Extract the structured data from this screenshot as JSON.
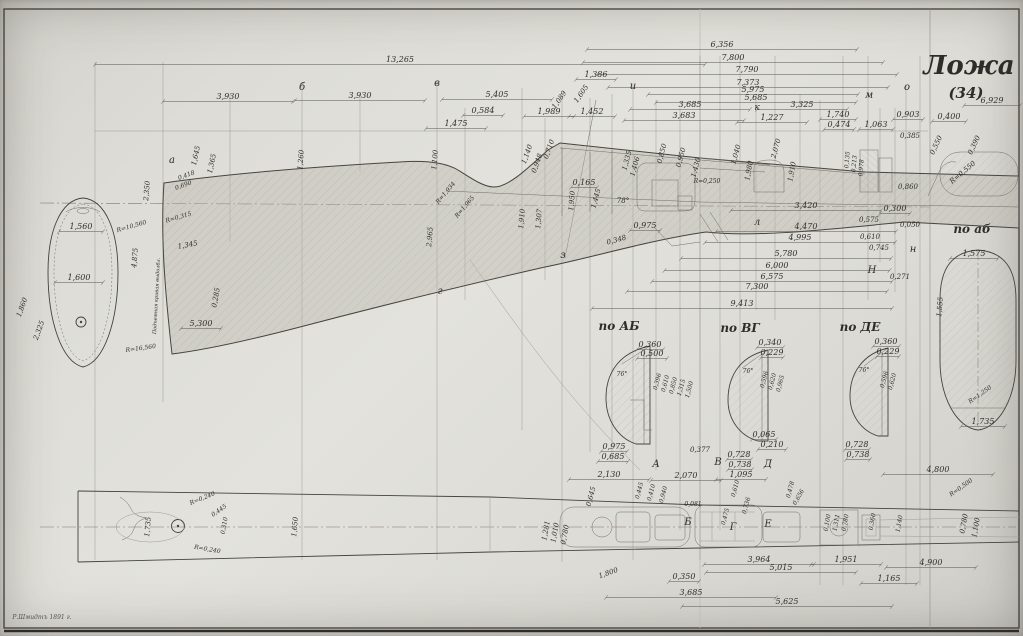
{
  "title": {
    "main": "Ложа",
    "sub": "(34)"
  },
  "section_labels": {
    "ab_upper": "по АБ",
    "vg": "по ВГ",
    "de": "по ДЕ",
    "ab_lower": "по аб"
  },
  "signature": "Р.Шмидтъ 1891 г.",
  "annotations": [
    {
      "t": "13,265",
      "x": 400,
      "y": 62,
      "w": 610
    },
    {
      "t": "3,930",
      "x": 228,
      "y": 99,
      "w": 130
    },
    {
      "t": "3,930",
      "x": 360,
      "y": 98,
      "w": 130
    },
    {
      "t": "5,405",
      "x": 497,
      "y": 97,
      "w": 110
    },
    {
      "t": "6,356",
      "x": 722,
      "y": 47,
      "w": 270
    },
    {
      "t": "7,800",
      "x": 733,
      "y": 60,
      "w": 300
    },
    {
      "t": "7,790",
      "x": 747,
      "y": 72,
      "w": 300
    },
    {
      "t": "7,373",
      "x": 748,
      "y": 85,
      "w": 280
    },
    {
      "t": "5,975",
      "x": 753,
      "y": 92,
      "w": 210
    },
    {
      "t": "5,685",
      "x": 756,
      "y": 100,
      "w": 200
    },
    {
      "t": "3,685",
      "x": 690,
      "y": 107,
      "w": 120
    },
    {
      "t": "3,683",
      "x": 684,
      "y": 118,
      "w": 120
    },
    {
      "t": "3,325",
      "x": 802,
      "y": 107,
      "w": 90
    },
    {
      "t": "1,227",
      "x": 772,
      "y": 120,
      "w": 70
    },
    {
      "t": "0,584",
      "x": 483,
      "y": 113,
      "w": 40
    },
    {
      "t": "1,475",
      "x": 456,
      "y": 126,
      "w": 60
    },
    {
      "t": "1,989",
      "x": 549,
      "y": 114,
      "w": 50
    },
    {
      "t": "1,452",
      "x": 592,
      "y": 114,
      "w": 46
    },
    {
      "t": "1,386",
      "x": 596,
      "y": 77,
      "w": 40
    },
    {
      "t": "1,740",
      "x": 838,
      "y": 117,
      "w": 36
    },
    {
      "t": "0,474",
      "x": 839,
      "y": 127,
      "w": 30
    },
    {
      "t": "1,063",
      "x": 876,
      "y": 127,
      "w": 34
    },
    {
      "t": "0,903",
      "x": 908,
      "y": 117,
      "w": 30
    },
    {
      "t": "0,400",
      "x": 949,
      "y": 119,
      "w": 34
    },
    {
      "t": "6,929",
      "x": 992,
      "y": 103,
      "w": 56
    },
    {
      "t": "0,385",
      "x": 910,
      "y": 138,
      "s": 7
    },
    {
      "t": "0,550",
      "x": 938,
      "y": 146,
      "r": -65,
      "s": 7
    },
    {
      "t": "0,390",
      "x": 976,
      "y": 146,
      "r": -65,
      "s": 7
    },
    {
      "t": "R=0,550",
      "x": 964,
      "y": 174,
      "r": -40,
      "s": 7
    },
    {
      "t": "0,860",
      "x": 908,
      "y": 189,
      "s": 7
    },
    {
      "t": "0,300",
      "x": 895,
      "y": 211,
      "w": 30
    },
    {
      "t": "3,420",
      "x": 806,
      "y": 208,
      "w": 150
    },
    {
      "t": "0,575",
      "x": 869,
      "y": 222,
      "s": 7
    },
    {
      "t": "0,050",
      "x": 910,
      "y": 227,
      "s": 7
    },
    {
      "t": "4,470",
      "x": 806,
      "y": 229,
      "w": 180
    },
    {
      "t": "4,995",
      "x": 800,
      "y": 240,
      "w": 190
    },
    {
      "t": "0,610",
      "x": 870,
      "y": 239,
      "s": 7
    },
    {
      "t": "0,745",
      "x": 879,
      "y": 250,
      "s": 7
    },
    {
      "t": "5,780",
      "x": 786,
      "y": 256,
      "w": 210
    },
    {
      "t": "6,000",
      "x": 777,
      "y": 268,
      "w": 225
    },
    {
      "t": "6,575",
      "x": 772,
      "y": 279,
      "w": 240
    },
    {
      "t": "7,300",
      "x": 757,
      "y": 289,
      "w": 260
    },
    {
      "t": "9,413",
      "x": 742,
      "y": 306,
      "w": 300
    },
    {
      "t": "0,271",
      "x": 900,
      "y": 279,
      "s": 7
    },
    {
      "t": "0,975",
      "x": 645,
      "y": 228,
      "w": 30
    },
    {
      "t": "0,348",
      "x": 617,
      "y": 242,
      "r": -15,
      "s": 7
    },
    {
      "t": "0,710",
      "x": 551,
      "y": 150,
      "r": -70,
      "s": 7
    },
    {
      "t": "1,140",
      "x": 529,
      "y": 155,
      "r": -70,
      "s": 7
    },
    {
      "t": "0,948",
      "x": 539,
      "y": 164,
      "r": -70,
      "s": 7
    },
    {
      "t": "1,605",
      "x": 583,
      "y": 95,
      "r": -55,
      "s": 7
    },
    {
      "t": "1,089",
      "x": 561,
      "y": 101,
      "r": -55,
      "s": 7
    },
    {
      "t": "0,850",
      "x": 664,
      "y": 154,
      "r": -75,
      "s": 7
    },
    {
      "t": "0,950",
      "x": 683,
      "y": 158,
      "r": -75,
      "s": 7
    },
    {
      "t": "1,430",
      "x": 698,
      "y": 168,
      "r": -75,
      "s": 7
    },
    {
      "t": "R=0,250",
      "x": 707,
      "y": 183,
      "s": 6
    },
    {
      "t": "1,040",
      "x": 738,
      "y": 155,
      "r": -75,
      "s": 7
    },
    {
      "t": "1,980",
      "x": 751,
      "y": 171,
      "r": -80,
      "s": 7
    },
    {
      "t": "2,070",
      "x": 778,
      "y": 149,
      "r": -75,
      "s": 7
    },
    {
      "t": "1,910",
      "x": 794,
      "y": 172,
      "r": -80,
      "s": 7
    },
    {
      "t": "1,335",
      "x": 629,
      "y": 161,
      "r": -75,
      "s": 7
    },
    {
      "t": "1,406",
      "x": 637,
      "y": 167,
      "r": -75,
      "s": 7
    },
    {
      "t": "78°",
      "x": 623,
      "y": 203,
      "s": 7
    },
    {
      "t": "0,165",
      "x": 584,
      "y": 185,
      "w": 26
    },
    {
      "t": "1,950",
      "x": 574,
      "y": 201,
      "r": -85,
      "s": 7
    },
    {
      "t": "1,445",
      "x": 598,
      "y": 199,
      "r": -75,
      "s": 7
    },
    {
      "t": "1,910",
      "x": 524,
      "y": 219,
      "r": -85,
      "s": 7
    },
    {
      "t": "1,307",
      "x": 541,
      "y": 219,
      "r": -85,
      "s": 7
    },
    {
      "t": "R=1,934",
      "x": 447,
      "y": 194,
      "r": -50,
      "s": 6
    },
    {
      "t": "R=1,965",
      "x": 466,
      "y": 208,
      "r": -50,
      "s": 6
    },
    {
      "t": "2,965",
      "x": 432,
      "y": 237,
      "r": -85,
      "s": 7
    },
    {
      "t": "1,100",
      "x": 437,
      "y": 160,
      "r": -85,
      "s": 7
    },
    {
      "t": "1,260",
      "x": 303,
      "y": 160,
      "r": -85,
      "s": 7
    },
    {
      "t": "2,350",
      "x": 149,
      "y": 191,
      "r": -85,
      "s": 7
    },
    {
      "t": "1,645",
      "x": 198,
      "y": 156,
      "r": -78,
      "s": 7
    },
    {
      "t": "1,365",
      "x": 214,
      "y": 164,
      "r": -78,
      "s": 7
    },
    {
      "t": "0,418",
      "x": 187,
      "y": 177,
      "r": -20,
      "s": 6
    },
    {
      "t": "0,690",
      "x": 184,
      "y": 187,
      "r": -20,
      "s": 6
    },
    {
      "t": "1,560",
      "x": 81,
      "y": 229,
      "w": 44
    },
    {
      "t": "1,600",
      "x": 79,
      "y": 280,
      "w": 48
    },
    {
      "t": "R=10,560",
      "x": 132,
      "y": 228,
      "r": -16,
      "s": 6
    },
    {
      "t": "R=0,315",
      "x": 179,
      "y": 219,
      "r": -16,
      "s": 6
    },
    {
      "t": "1,345",
      "x": 188,
      "y": 247,
      "r": -10,
      "s": 7
    },
    {
      "t": "4,875",
      "x": 137,
      "y": 258,
      "r": -85,
      "s": 7
    },
    {
      "t": "5,300",
      "x": 201,
      "y": 326,
      "w": 40
    },
    {
      "t": "R=16,560",
      "x": 141,
      "y": 350,
      "r": -8,
      "s": 6
    },
    {
      "t": "0,285",
      "x": 218,
      "y": 298,
      "r": -80,
      "s": 7
    },
    {
      "t": "2,325",
      "x": 41,
      "y": 331,
      "r": -70,
      "s": 7
    },
    {
      "t": "1,860",
      "x": 24,
      "y": 308,
      "r": -70,
      "s": 7
    },
    {
      "t": "Подъемная кривая выдолбл.",
      "x": 158,
      "y": 296,
      "r": -87,
      "s": 5
    },
    {
      "t": "а",
      "x": 172,
      "y": 163,
      "s": 10
    },
    {
      "t": "б",
      "x": 302,
      "y": 90,
      "s": 10
    },
    {
      "t": "в",
      "x": 437,
      "y": 86,
      "s": 10
    },
    {
      "t": "г",
      "x": 440,
      "y": 294,
      "s": 10
    },
    {
      "t": "з",
      "x": 563,
      "y": 258,
      "s": 10
    },
    {
      "t": "и",
      "x": 633,
      "y": 89,
      "s": 10
    },
    {
      "t": "к",
      "x": 757,
      "y": 110,
      "s": 9
    },
    {
      "t": "м",
      "x": 869,
      "y": 98,
      "s": 10
    },
    {
      "t": "о",
      "x": 907,
      "y": 90,
      "s": 10
    },
    {
      "t": "л",
      "x": 757,
      "y": 225,
      "s": 10
    },
    {
      "t": "н",
      "x": 913,
      "y": 252,
      "s": 10
    },
    {
      "t": "Н",
      "x": 872,
      "y": 273,
      "s": 10
    },
    {
      "t": "А",
      "x": 656,
      "y": 467,
      "s": 10
    },
    {
      "t": "В",
      "x": 718,
      "y": 465,
      "s": 10
    },
    {
      "t": "Д",
      "x": 768,
      "y": 467,
      "s": 10
    },
    {
      "t": "Б",
      "x": 688,
      "y": 525,
      "s": 10
    },
    {
      "t": "Г",
      "x": 733,
      "y": 530,
      "s": 10
    },
    {
      "t": "Е",
      "x": 768,
      "y": 527,
      "s": 10
    },
    {
      "t": "0,360",
      "x": 650,
      "y": 347,
      "w": 26
    },
    {
      "t": "0,500",
      "x": 652,
      "y": 356,
      "w": 30
    },
    {
      "t": "0,340",
      "x": 770,
      "y": 345,
      "w": 26
    },
    {
      "t": "0,229",
      "x": 772,
      "y": 355,
      "w": 22
    },
    {
      "t": "0,360",
      "x": 886,
      "y": 344,
      "w": 26
    },
    {
      "t": "0,229",
      "x": 888,
      "y": 354,
      "w": 22
    },
    {
      "t": "76°",
      "x": 622,
      "y": 376,
      "s": 6
    },
    {
      "t": "76°",
      "x": 748,
      "y": 373,
      "s": 6
    },
    {
      "t": "76°",
      "x": 864,
      "y": 372,
      "s": 6
    },
    {
      "t": "0,396",
      "x": 659,
      "y": 382,
      "r": -75,
      "s": 6
    },
    {
      "t": "0,610",
      "x": 667,
      "y": 384,
      "r": -75,
      "s": 6
    },
    {
      "t": "0,850",
      "x": 675,
      "y": 386,
      "r": -75,
      "s": 6
    },
    {
      "t": "1,315",
      "x": 683,
      "y": 388,
      "r": -75,
      "s": 6
    },
    {
      "t": "1,500",
      "x": 691,
      "y": 390,
      "r": -75,
      "s": 6
    },
    {
      "t": "0,596",
      "x": 766,
      "y": 380,
      "r": -75,
      "s": 6
    },
    {
      "t": "0,620",
      "x": 774,
      "y": 382,
      "r": -75,
      "s": 6
    },
    {
      "t": "0,965",
      "x": 782,
      "y": 384,
      "r": -75,
      "s": 6
    },
    {
      "t": "0,596",
      "x": 886,
      "y": 380,
      "r": -75,
      "s": 6
    },
    {
      "t": "0,620",
      "x": 894,
      "y": 382,
      "r": -75,
      "s": 6
    },
    {
      "t": "0,975",
      "x": 614,
      "y": 449,
      "w": 26
    },
    {
      "t": "0,685",
      "x": 613,
      "y": 459,
      "w": 30
    },
    {
      "t": "0,065",
      "x": 764,
      "y": 437,
      "w": 24
    },
    {
      "t": "0,210",
      "x": 772,
      "y": 447,
      "w": 28
    },
    {
      "t": "0,377",
      "x": 700,
      "y": 452,
      "s": 7
    },
    {
      "t": "0,728",
      "x": 739,
      "y": 457,
      "w": 24
    },
    {
      "t": "0,738",
      "x": 740,
      "y": 467,
      "w": 24
    },
    {
      "t": "0,728",
      "x": 857,
      "y": 447,
      "w": 24
    },
    {
      "t": "0,738",
      "x": 858,
      "y": 457,
      "w": 24
    },
    {
      "t": "1,575",
      "x": 974,
      "y": 256,
      "w": 48
    },
    {
      "t": "1,555",
      "x": 942,
      "y": 307,
      "r": -85,
      "s": 7
    },
    {
      "t": "R=1,250",
      "x": 981,
      "y": 396,
      "r": -35,
      "s": 6
    },
    {
      "t": "1,735",
      "x": 983,
      "y": 424,
      "w": 44
    },
    {
      "t": "R=0,240",
      "x": 203,
      "y": 500,
      "r": -22,
      "s": 6
    },
    {
      "t": "0,445",
      "x": 220,
      "y": 512,
      "r": -35,
      "s": 6
    },
    {
      "t": "0,310",
      "x": 226,
      "y": 526,
      "r": -80,
      "s": 6
    },
    {
      "t": "R=0,240",
      "x": 207,
      "y": 551,
      "r": 10,
      "s": 6
    },
    {
      "t": "1,735",
      "x": 150,
      "y": 527,
      "r": -85,
      "s": 7
    },
    {
      "t": "1,650",
      "x": 297,
      "y": 527,
      "r": -85,
      "s": 7
    },
    {
      "t": "2,130",
      "x": 609,
      "y": 477,
      "w": 80
    },
    {
      "t": "2,070",
      "x": 686,
      "y": 478,
      "w": 70
    },
    {
      "t": "1,095",
      "x": 741,
      "y": 477,
      "w": 50
    },
    {
      "t": "0,645",
      "x": 593,
      "y": 497,
      "r": -75,
      "s": 7
    },
    {
      "t": "1,281",
      "x": 548,
      "y": 531,
      "r": -80,
      "s": 7
    },
    {
      "t": "1,010",
      "x": 557,
      "y": 533,
      "r": -80,
      "s": 7
    },
    {
      "t": "0,780",
      "x": 567,
      "y": 535,
      "r": -80,
      "s": 7
    },
    {
      "t": "0,445",
      "x": 641,
      "y": 491,
      "r": -75,
      "s": 6
    },
    {
      "t": "0,410",
      "x": 653,
      "y": 493,
      "r": -75,
      "s": 6
    },
    {
      "t": "0,940",
      "x": 665,
      "y": 495,
      "r": -75,
      "s": 6
    },
    {
      "t": "0,081",
      "x": 693,
      "y": 506,
      "s": 6
    },
    {
      "t": "0,610",
      "x": 737,
      "y": 489,
      "r": -75,
      "s": 6
    },
    {
      "t": "0,736",
      "x": 748,
      "y": 506,
      "r": -75,
      "s": 6
    },
    {
      "t": "0,475",
      "x": 727,
      "y": 517,
      "r": -75,
      "s": 6
    },
    {
      "t": "0,478",
      "x": 792,
      "y": 490,
      "r": -75,
      "s": 6
    },
    {
      "t": "0,656",
      "x": 800,
      "y": 498,
      "r": -60,
      "s": 6
    },
    {
      "t": "4,800",
      "x": 938,
      "y": 472,
      "w": 110
    },
    {
      "t": "R=0,500",
      "x": 962,
      "y": 489,
      "r": -35,
      "s": 6
    },
    {
      "t": "0,100",
      "x": 829,
      "y": 523,
      "r": -80,
      "s": 6
    },
    {
      "t": "1,311",
      "x": 838,
      "y": 523,
      "r": -80,
      "s": 6
    },
    {
      "t": "0,780",
      "x": 847,
      "y": 523,
      "r": -80,
      "s": 6
    },
    {
      "t": "0,360",
      "x": 874,
      "y": 522,
      "r": -80,
      "s": 6
    },
    {
      "t": "1,140",
      "x": 901,
      "y": 524,
      "r": -80,
      "s": 6
    },
    {
      "t": "0,780",
      "x": 966,
      "y": 524,
      "r": -80,
      "s": 7
    },
    {
      "t": "1,100",
      "x": 978,
      "y": 528,
      "r": -80,
      "s": 7
    },
    {
      "t": "0,135",
      "x": 849,
      "y": 160,
      "r": -85,
      "s": 6
    },
    {
      "t": "0,213",
      "x": 856,
      "y": 164,
      "r": -85,
      "s": 6
    },
    {
      "t": "0,978",
      "x": 863,
      "y": 168,
      "r": -85,
      "s": 6
    },
    {
      "t": "1,951",
      "x": 846,
      "y": 562,
      "w": 70
    },
    {
      "t": "1,165",
      "x": 889,
      "y": 581,
      "w": 56
    },
    {
      "t": "4,900",
      "x": 931,
      "y": 565,
      "w": 90
    },
    {
      "t": "3,964",
      "x": 759,
      "y": 562,
      "w": 110
    },
    {
      "t": "5,015",
      "x": 781,
      "y": 570,
      "w": 150
    },
    {
      "t": "3,685",
      "x": 691,
      "y": 595,
      "w": 170
    },
    {
      "t": "5,625",
      "x": 787,
      "y": 604,
      "w": 210
    },
    {
      "t": "1,800",
      "x": 609,
      "y": 575,
      "r": -20,
      "s": 7
    },
    {
      "t": "0,350",
      "x": 684,
      "y": 579,
      "w": 30
    },
    {
      "t": "по АБ",
      "x": 619,
      "y": 330,
      "s": 12,
      "c": "sec"
    },
    {
      "t": "по ВГ",
      "x": 740,
      "y": 332,
      "s": 12,
      "c": "sec"
    },
    {
      "t": "по ДЕ",
      "x": 860,
      "y": 331,
      "s": 12,
      "c": "sec"
    },
    {
      "t": "по аб",
      "x": 972,
      "y": 233,
      "s": 12,
      "c": "sec"
    },
    {
      "t": "Ложа",
      "x": 969,
      "y": 74,
      "s": 26,
      "c": "title"
    },
    {
      "t": "(34)",
      "x": 966,
      "y": 98,
      "s": 15,
      "c": "title"
    },
    {
      "t": "Р.Шмидтъ 1891 г.",
      "x": 42,
      "y": 619,
      "s": 6,
      "c": "sig"
    }
  ]
}
